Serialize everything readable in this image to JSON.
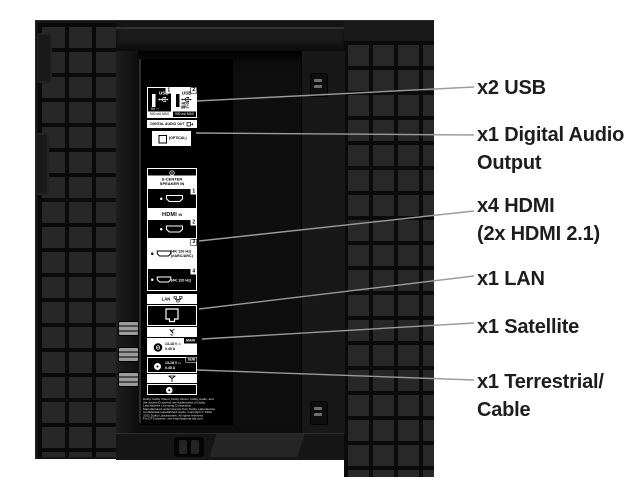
{
  "colors": {
    "panel": "#141414",
    "tile": "#272727",
    "leader_line": "#9b9b9b",
    "annotation_text": "#1d1d1d",
    "label_white": "#ffffff"
  },
  "annotations": [
    {
      "id": "usb",
      "label": "x2 USB"
    },
    {
      "id": "digital-audio",
      "label": "x1 Digital Audio\nOutput"
    },
    {
      "id": "hdmi",
      "label": "x4 HDMI\n(2x HDMI 2.1)"
    },
    {
      "id": "lan",
      "label": "x1 LAN"
    },
    {
      "id": "satellite",
      "label": "x1 Satellite"
    },
    {
      "id": "terrestrial",
      "label": "x1 Terrestrial/\nCable"
    }
  ],
  "ports": {
    "usb1": {
      "num": "1",
      "name": "USB",
      "volt": "5V ⎓",
      "amp": "500 mA MAX"
    },
    "usb2": {
      "num": "2",
      "name": "USB",
      "hdd": "HDD REC",
      "volt": "5V ⎓",
      "amp": "900 mA MAX"
    },
    "digital_audio": {
      "header": "DIGITAL AUDIO OUT",
      "label": "(OPTICAL)"
    },
    "s_center": {
      "label": "S-CENTER\nSPEAKER IN"
    },
    "hdmi": {
      "logo": "HDMI",
      "suffix": "IN",
      "num1": "1",
      "num2": "2",
      "num3": "3",
      "num4": "4",
      "spec3a": "(4K 120 Hz)",
      "spec3b": "(eARC/ARC)",
      "spec4": "(4K 120 Hz)"
    },
    "lan": {
      "label": "LAN"
    },
    "sat_main": {
      "badge": "MAIN",
      "volt": "13-18 V ⎓",
      "amp": "0.45 A"
    },
    "sat_sub": {
      "badge": "SUB",
      "volt": "13-18 V ⎓",
      "amp": "0.45 A"
    },
    "legal": "Dolby, Dolby Vision, Dolby Atmos, Dolby Audio, and\nthe double-D symbol are trademarks of Dolby\nLaboratories Licensing Corporation.\nManufactured under license from Dolby Laboratories.\nConfidential unpublished works. Copyright © 1992-\n2022 Dolby Laboratories. All rights reserved.\nFor DTS patents, see http://patents.dts.com."
  }
}
